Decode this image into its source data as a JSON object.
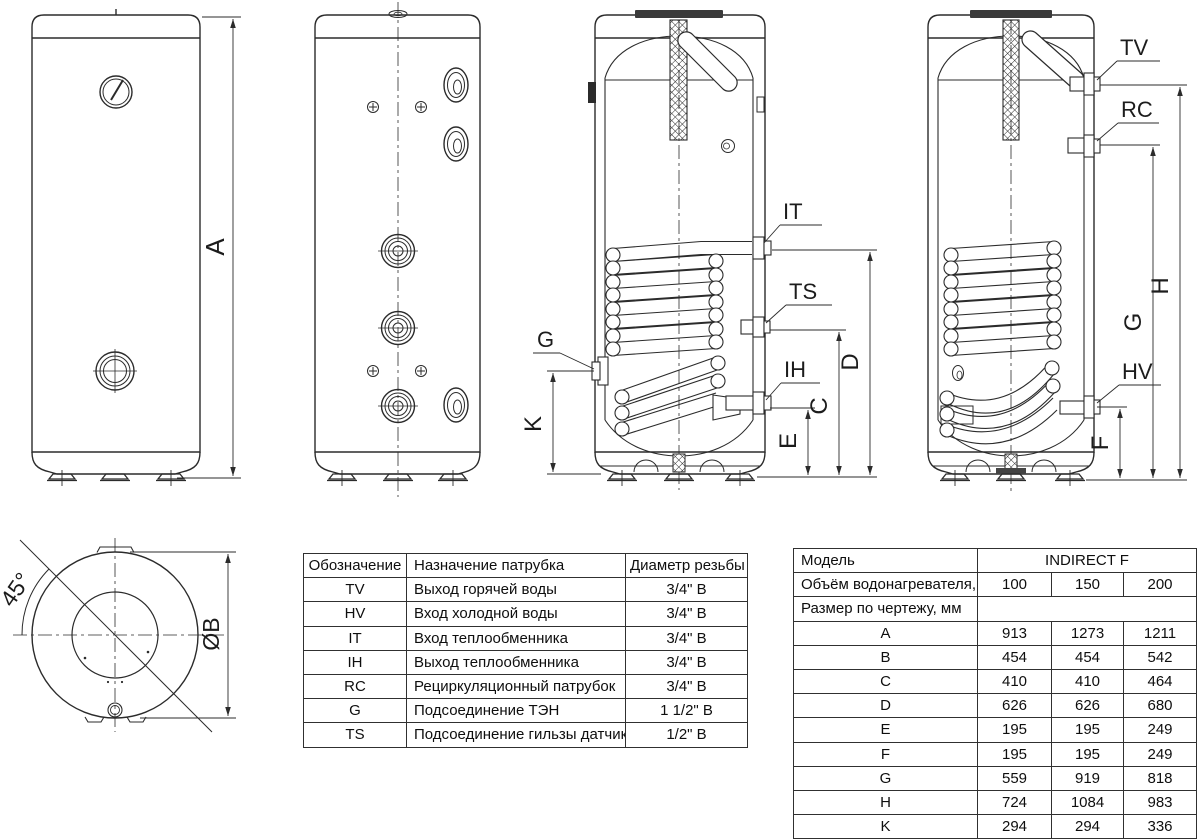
{
  "drawing": {
    "labels": {
      "dim_a": "A",
      "it": "IT",
      "ts": "TS",
      "ih": "IH",
      "g_port": "G",
      "dim_k": "K",
      "dim_d": "D",
      "dim_c": "C",
      "dim_e": "E",
      "tv": "TV",
      "rc": "RC",
      "hv": "HV",
      "dim_h": "H",
      "dim_g": "G",
      "dim_f": "F",
      "angle": "45°",
      "diameter": "ØB"
    },
    "line_color": "#2b2b2b"
  },
  "ports_table": {
    "headers": [
      "Обозначение",
      "Назначение патрубка",
      "Диаметр резьбы"
    ],
    "rows": [
      [
        "TV",
        "Выход горячей воды",
        "3/4\" В"
      ],
      [
        "HV",
        "Вход холодной воды",
        "3/4\" В"
      ],
      [
        "IT",
        "Вход теплообменника",
        "3/4\" В"
      ],
      [
        "IH",
        "Выход теплообменника",
        "3/4\" В"
      ],
      [
        "RC",
        "Рециркуляционный патрубок",
        "3/4\" В"
      ],
      [
        "G",
        "Подсоединение ТЭН",
        "1 1/2\" В"
      ],
      [
        "TS",
        "Подсоединение гильзы датчика",
        "1/2\" В"
      ]
    ]
  },
  "specs_table": {
    "model_label": "Модель",
    "model_value": "INDIRECT F",
    "volume_label": "Объём водонагревателя, л",
    "volumes": [
      "100",
      "150",
      "200"
    ],
    "size_label": "Размер по чертежу, мм",
    "dims": [
      {
        "name": "A",
        "values": [
          "913",
          "1273",
          "1211"
        ]
      },
      {
        "name": "B",
        "values": [
          "454",
          "454",
          "542"
        ]
      },
      {
        "name": "C",
        "values": [
          "410",
          "410",
          "464"
        ]
      },
      {
        "name": "D",
        "values": [
          "626",
          "626",
          "680"
        ]
      },
      {
        "name": "E",
        "values": [
          "195",
          "195",
          "249"
        ]
      },
      {
        "name": "F",
        "values": [
          "195",
          "195",
          "249"
        ]
      },
      {
        "name": "G",
        "values": [
          "559",
          "919",
          "818"
        ]
      },
      {
        "name": "H",
        "values": [
          "724",
          "1084",
          "983"
        ]
      },
      {
        "name": "K",
        "values": [
          "294",
          "294",
          "336"
        ]
      }
    ]
  }
}
